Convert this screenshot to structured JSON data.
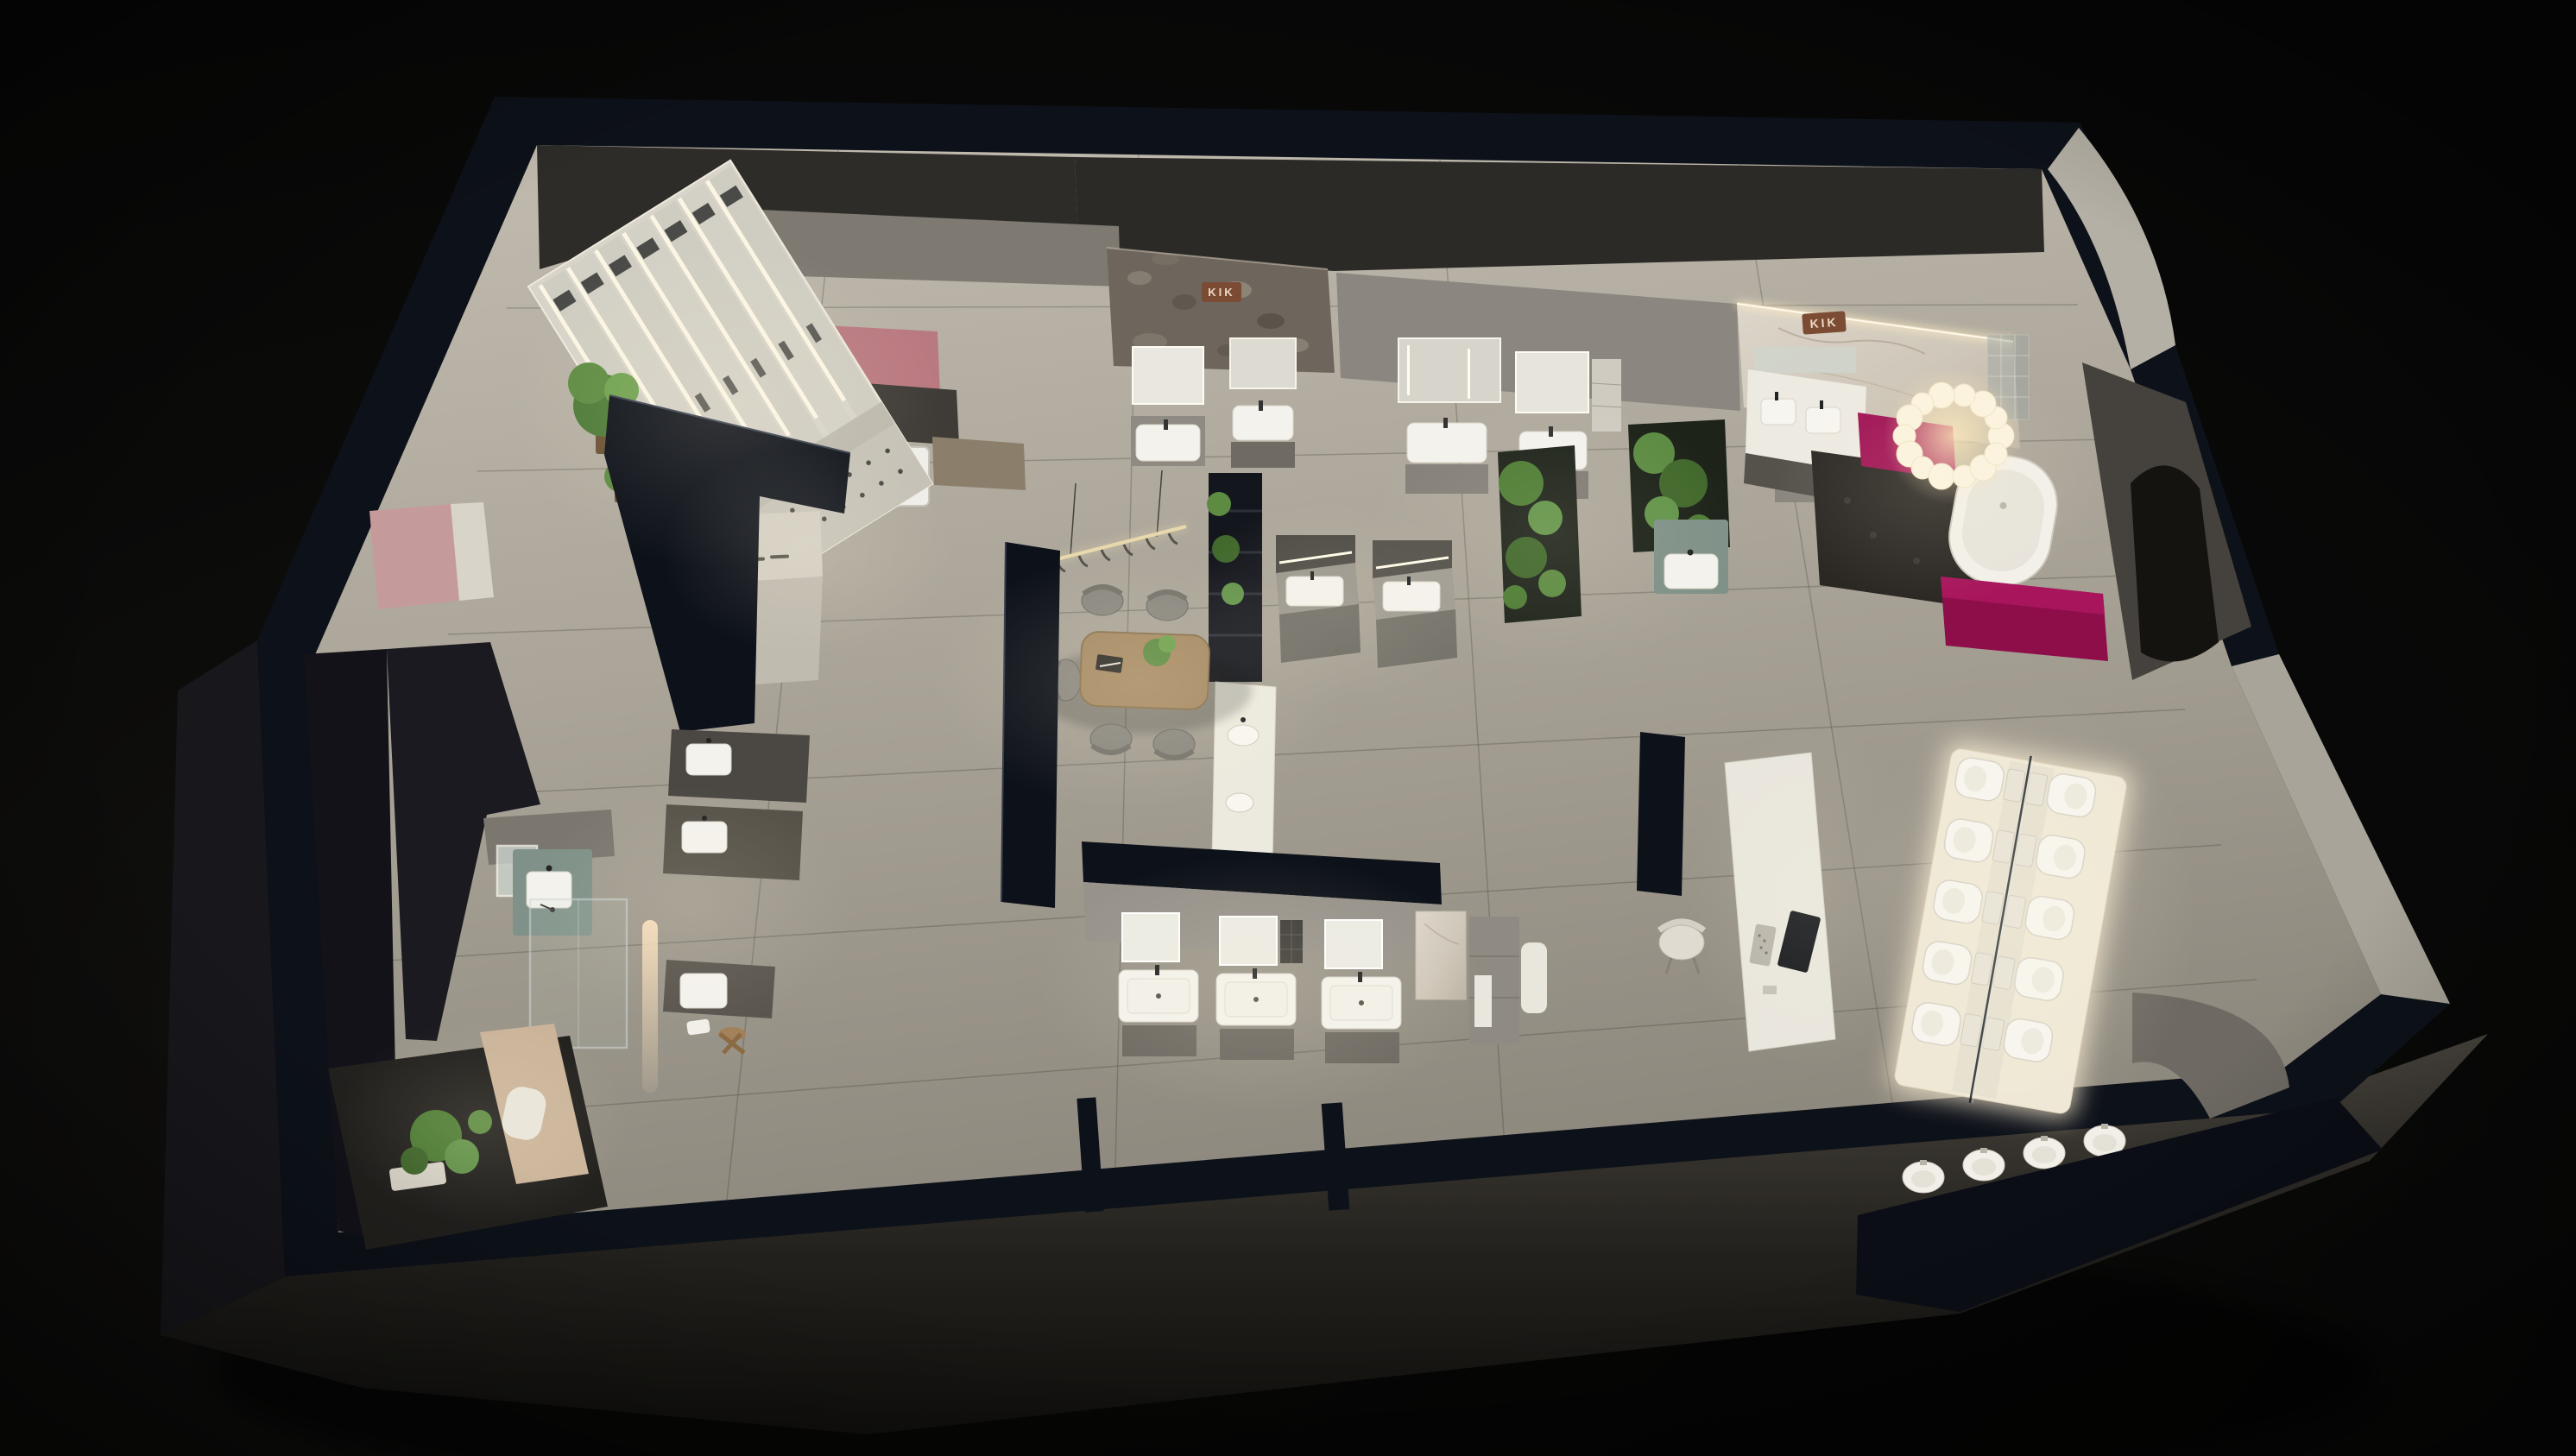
{
  "meta": {
    "scene_type": "3d-dollhouse-render",
    "subject": "bathroom-sanitaryware-showroom-floorplan",
    "lighting": "night-interior-spotlights"
  },
  "brand": {
    "name": "KIK"
  },
  "signs": {
    "stone_wall_sign": {
      "text": "KIK"
    },
    "marble_wall_sign": {
      "text": "KIK"
    }
  },
  "palette": {
    "bg": "#0a0a09",
    "plinth": "#45423c",
    "wall_navy": "#0d1119",
    "floor_top": "#c2bcb0",
    "floor_bottom": "#8e897e",
    "wall_gray": "#8b8780",
    "soffit": "#2e2c29",
    "white_fixture": "#f4f2ec",
    "cabinet_gray": "#7a776f",
    "cabinet_dark": "#4a4641",
    "wood": "#a68a63",
    "chair_gray": "#8b8880",
    "plant_green": "#5d8b42",
    "mauve_panel": "#b97980",
    "pink_wall": "#c59a9b",
    "magenta": "#a01254",
    "magenta_dark": "#8e0e4a",
    "marble": "#d9d2c5",
    "stone": "#6e665d",
    "copper": "#7c4b33",
    "copper_text": "#ead9c5",
    "glow": "#ffedc2",
    "pebble_floor": "#2b2824",
    "teal_cabinet": "#7f9188",
    "tan_wall": "#cbb49a",
    "glass": "#9aa4a0",
    "screen_dark": "#17191d"
  },
  "fixtures": {
    "shower_display_panels": 7,
    "toilets_on_platform": 10,
    "urinals_bottom_wall": 4,
    "freestanding_bathtubs": 1,
    "washing_machines": 1,
    "table_chairs": 5,
    "console_chairs": 1,
    "vanity_units": 15,
    "plant_beds": 2,
    "chandelier_bubbles": 14
  },
  "zones": [
    {
      "id": "shower-display-wall",
      "label": "shower fixture display wall"
    },
    {
      "id": "laundry-display",
      "label": "laundry appliance nook"
    },
    {
      "id": "reception-desk",
      "label": "reception desk"
    },
    {
      "id": "consultation-table",
      "label": "consultation table with chairs"
    },
    {
      "id": "vanity-gallery",
      "label": "vanity and mirror displays"
    },
    {
      "id": "kik-bath-suite",
      "label": "marble bath suite with freestanding tub"
    },
    {
      "id": "toilet-platform",
      "label": "illuminated toilet display platform"
    },
    {
      "id": "demo-console",
      "label": "smart toilet demo console"
    },
    {
      "id": "urinal-row",
      "label": "wall-hung urinal row"
    },
    {
      "id": "courtyard-plants",
      "label": "planted courtyard corner"
    }
  ]
}
